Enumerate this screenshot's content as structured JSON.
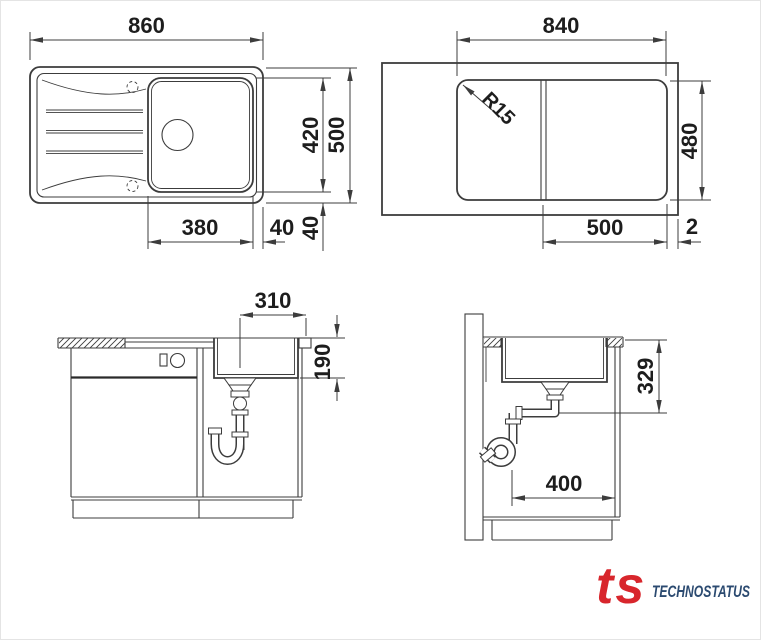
{
  "colors": {
    "line": "#3c3c3c",
    "dimension_text": "#1d1d1d",
    "background": "#ffffff",
    "logo_icon_red": "#d8262c",
    "logo_brand_navy": "#2b4a70"
  },
  "views": {
    "top": {
      "dim_overall_width": "860",
      "dim_bowl_length": "420",
      "dim_overall_depth": "500",
      "dim_bowl_width": "380",
      "dim_gap_right": "40",
      "dim_gap_bottom": "40"
    },
    "cutout": {
      "dim_cutout_width": "840",
      "dim_corner_radius": "R15",
      "dim_cutout_depth": "480",
      "dim_bowl_zone_width": "500",
      "dim_edge_gap": "2"
    },
    "front": {
      "dim_drain_offset": "310",
      "dim_bowl_depth": "190"
    },
    "side": {
      "dim_drain_height": "329",
      "dim_base_depth": "400"
    }
  },
  "logo": {
    "icon_text": "ts",
    "brand_text": "TECHNOSTATUS"
  }
}
